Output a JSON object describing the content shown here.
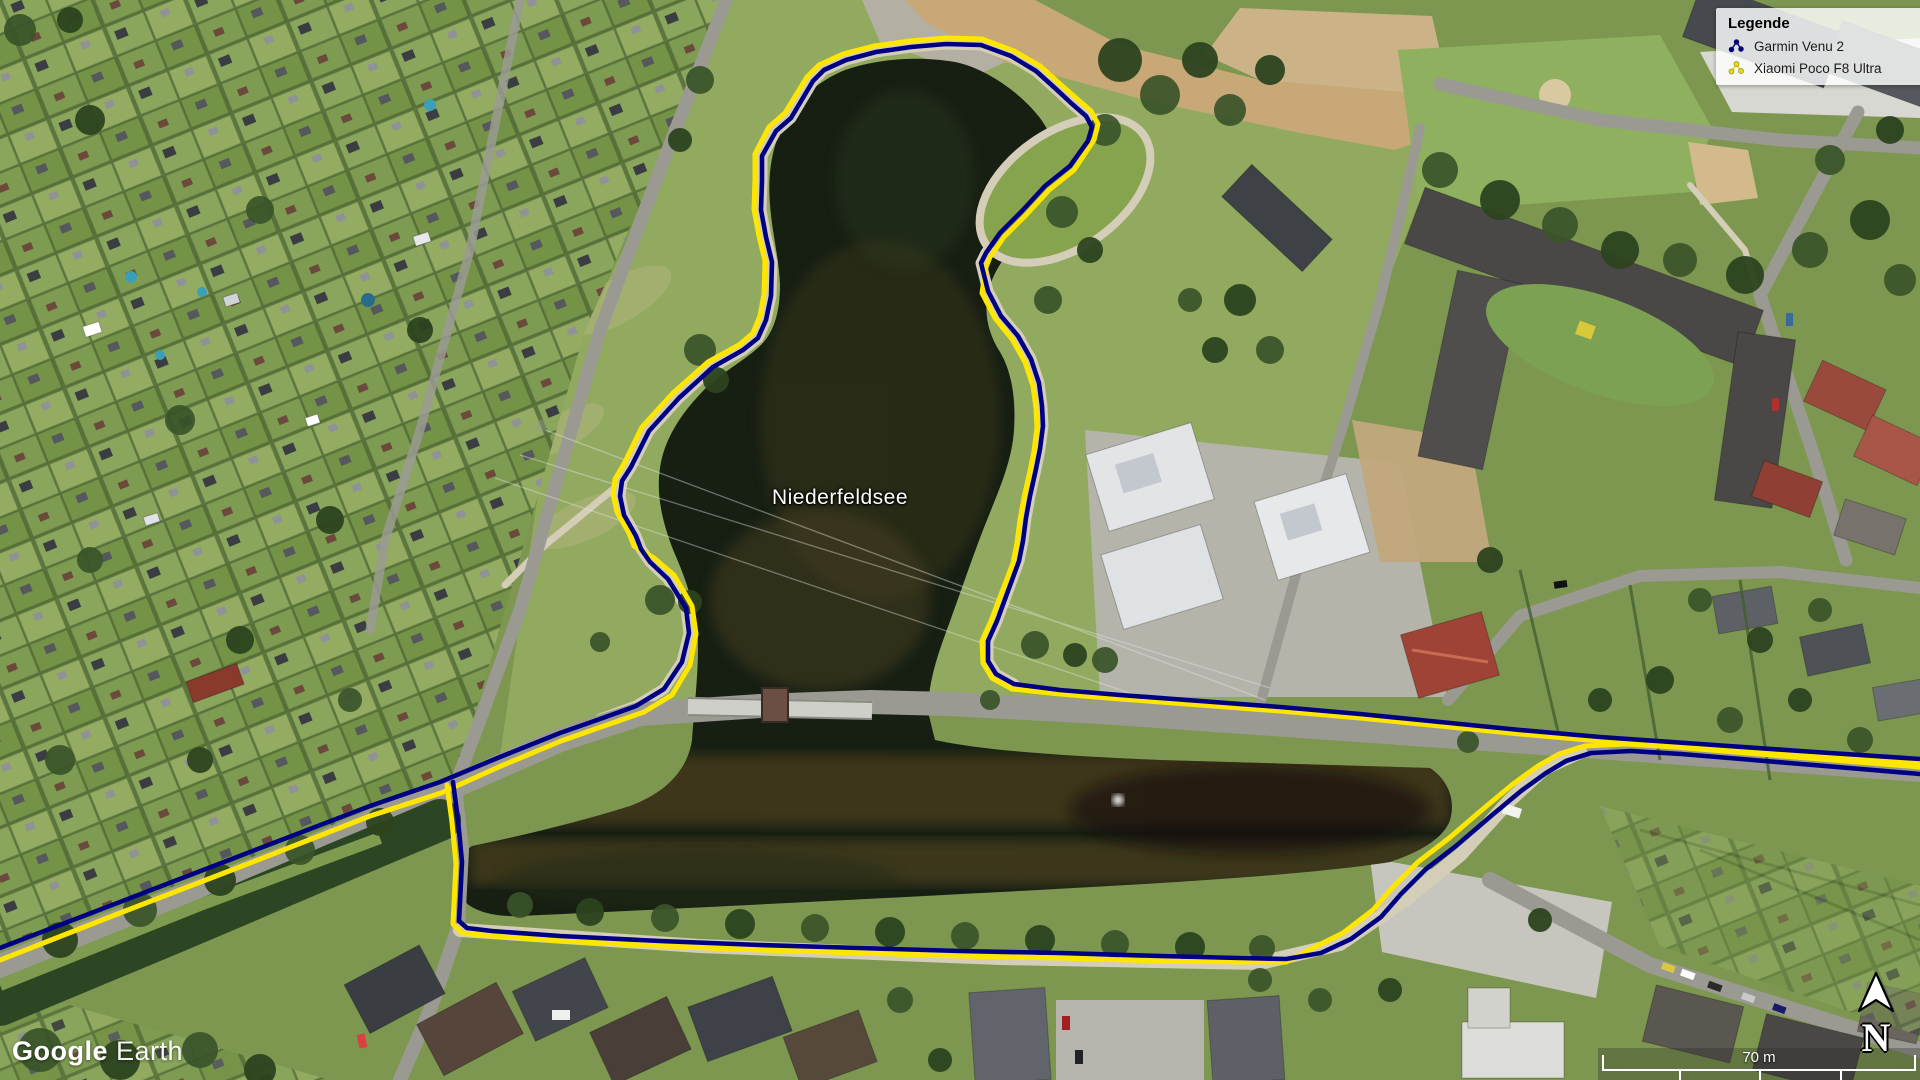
{
  "map": {
    "place_label": "Niederfeldsee",
    "watermark": {
      "brand": "Google",
      "product": "Earth"
    },
    "scale_bar": {
      "label": "70 m"
    },
    "north_indicator": {
      "letter": "N"
    },
    "legend": {
      "title": "Legende",
      "items": [
        {
          "label": "Garmin Venu 2",
          "icon": "track-dots-icon",
          "color": "#000082"
        },
        {
          "label": "Xiaomi Poco F8 Ultra",
          "icon": "track-dots-icon",
          "color": "#e9db00"
        }
      ]
    },
    "tracks": [
      {
        "id": "garmin-venu-2",
        "name": "Garmin Venu 2",
        "color": "#000082",
        "width": 4.6,
        "segments": [
          [
            [
              0,
              948
            ],
            [
              120,
              902
            ],
            [
              250,
              852
            ],
            [
              370,
              806
            ],
            [
              440,
              782
            ],
            [
              500,
              757
            ],
            [
              560,
              733
            ],
            [
              600,
              719
            ],
            [
              636,
              706
            ],
            [
              664,
              689
            ],
            [
              682,
              662
            ],
            [
              689,
              633
            ],
            [
              686,
              608
            ],
            [
              668,
              579
            ],
            [
              650,
              562
            ],
            [
              641,
              549
            ],
            [
              636,
              536
            ],
            [
              624,
              515
            ],
            [
              620,
              496
            ],
            [
              622,
              481
            ],
            [
              631,
              467
            ],
            [
              649,
              431
            ],
            [
              679,
              398
            ],
            [
              713,
              367
            ],
            [
              743,
              350
            ],
            [
              758,
              338
            ],
            [
              766,
              320
            ],
            [
              771,
              296
            ],
            [
              772,
              262
            ],
            [
              766,
              237
            ],
            [
              761,
              210
            ],
            [
              762,
              181
            ],
            [
              762,
              156
            ],
            [
              776,
              131
            ],
            [
              791,
              118
            ],
            [
              813,
              81
            ],
            [
              824,
              70
            ],
            [
              846,
              60
            ],
            [
              876,
              52
            ],
            [
              911,
              47
            ],
            [
              946,
              44
            ],
            [
              981,
              45
            ],
            [
              1011,
              56
            ],
            [
              1036,
              71
            ],
            [
              1056,
              89
            ],
            [
              1071,
              103
            ],
            [
              1086,
              116
            ],
            [
              1092,
              127
            ],
            [
              1088,
              141
            ],
            [
              1070,
              166
            ],
            [
              1045,
              186
            ],
            [
              1022,
              211
            ],
            [
              1000,
              233
            ],
            [
              986,
              253
            ],
            [
              981,
              263
            ],
            [
              988,
              291
            ],
            [
              1001,
              316
            ],
            [
              1018,
              336
            ],
            [
              1031,
              359
            ],
            [
              1039,
              383
            ],
            [
              1042,
              406
            ],
            [
              1043,
              426
            ],
            [
              1040,
              449
            ],
            [
              1036,
              469
            ],
            [
              1030,
              496
            ],
            [
              1026,
              518
            ],
            [
              1023,
              541
            ],
            [
              1019,
              561
            ],
            [
              1008,
              591
            ],
            [
              997,
              621
            ],
            [
              988,
              641
            ],
            [
              988,
              661
            ],
            [
              996,
              674
            ],
            [
              1014,
              684
            ],
            [
              1060,
              690
            ],
            [
              1120,
              695
            ],
            [
              1200,
              701
            ],
            [
              1280,
              707
            ],
            [
              1360,
              714
            ],
            [
              1440,
              722
            ],
            [
              1520,
              730
            ],
            [
              1600,
              737
            ],
            [
              1700,
              744
            ],
            [
              1800,
              751
            ],
            [
              1920,
              759
            ]
          ],
          [
            [
              453,
              782
            ],
            [
              458,
              820
            ],
            [
              462,
              862
            ],
            [
              460,
              902
            ],
            [
              459,
              921
            ],
            [
              467,
              928
            ],
            [
              492,
              931
            ],
            [
              560,
              936
            ],
            [
              660,
              941
            ],
            [
              760,
              945
            ],
            [
              860,
              948
            ],
            [
              960,
              951
            ],
            [
              1060,
              953
            ],
            [
              1160,
              956
            ],
            [
              1240,
              958
            ],
            [
              1286,
              959
            ],
            [
              1321,
              953
            ],
            [
              1351,
              939
            ],
            [
              1381,
              917
            ],
            [
              1401,
              894
            ],
            [
              1426,
              869
            ],
            [
              1456,
              846
            ],
            [
              1491,
              816
            ],
            [
              1521,
              791
            ],
            [
              1546,
              773
            ],
            [
              1566,
              761
            ],
            [
              1591,
              753
            ],
            [
              1631,
              751
            ],
            [
              1681,
              754
            ],
            [
              1741,
              759
            ],
            [
              1801,
              764
            ],
            [
              1920,
              774
            ]
          ]
        ]
      },
      {
        "id": "xiaomi-poco-f8-ultra",
        "name": "Xiaomi Poco F8 Ultra",
        "color": "#ffe600",
        "width": 5,
        "segments": [
          [
            [
              0,
              960
            ],
            [
              120,
              913
            ],
            [
              250,
              863
            ],
            [
              370,
              816
            ],
            [
              441,
              793
            ],
            [
              501,
              766
            ],
            [
              561,
              741
            ],
            [
              601,
              727
            ],
            [
              644,
              712
            ],
            [
              672,
              695
            ],
            [
              690,
              665
            ],
            [
              696,
              634
            ],
            [
              692,
              606
            ],
            [
              674,
              575
            ],
            [
              654,
              558
            ],
            [
              634,
              546
            ],
            [
              629,
              533
            ],
            [
              617,
              512
            ],
            [
              613,
              494
            ],
            [
              615,
              479
            ],
            [
              624,
              464
            ],
            [
              642,
              427
            ],
            [
              673,
              393
            ],
            [
              708,
              362
            ],
            [
              739,
              345
            ],
            [
              753,
              333
            ],
            [
              760,
              316
            ],
            [
              764,
              294
            ],
            [
              765,
              261
            ],
            [
              759,
              236
            ],
            [
              754,
              209
            ],
            [
              755,
              180
            ],
            [
              755,
              154
            ],
            [
              769,
              127
            ],
            [
              785,
              113
            ],
            [
              807,
              77
            ],
            [
              819,
              65
            ],
            [
              843,
              54
            ],
            [
              874,
              46
            ],
            [
              910,
              41
            ],
            [
              946,
              38
            ],
            [
              982,
              39
            ],
            [
              1014,
              51
            ],
            [
              1040,
              66
            ],
            [
              1060,
              84
            ],
            [
              1076,
              98
            ],
            [
              1091,
              111
            ],
            [
              1098,
              124
            ],
            [
              1094,
              140
            ],
            [
              1074,
              170
            ],
            [
              1049,
              190
            ],
            [
              1026,
              215
            ],
            [
              1004,
              237
            ],
            [
              990,
              257
            ],
            [
              986,
              267
            ],
            [
              982,
              293
            ],
            [
              995,
              318
            ],
            [
              1012,
              339
            ],
            [
              1025,
              362
            ],
            [
              1033,
              386
            ],
            [
              1036,
              408
            ],
            [
              1037,
              428
            ],
            [
              1034,
              451
            ],
            [
              1030,
              471
            ],
            [
              1024,
              498
            ],
            [
              1020,
              520
            ],
            [
              1017,
              543
            ],
            [
              1013,
              563
            ],
            [
              1002,
              592
            ],
            [
              991,
              621
            ],
            [
              982,
              641
            ],
            [
              983,
              663
            ],
            [
              992,
              678
            ],
            [
              1012,
              689
            ],
            [
              1060,
              694
            ],
            [
              1120,
              699
            ],
            [
              1200,
              705
            ],
            [
              1280,
              711
            ],
            [
              1360,
              718
            ],
            [
              1440,
              726
            ],
            [
              1520,
              734
            ],
            [
              1600,
              741
            ],
            [
              1700,
              748
            ],
            [
              1800,
              755
            ],
            [
              1920,
              763
            ]
          ],
          [
            [
              447,
              785
            ],
            [
              452,
              822
            ],
            [
              456,
              864
            ],
            [
              454,
              904
            ],
            [
              453,
              924
            ],
            [
              462,
              933
            ],
            [
              492,
              936
            ],
            [
              560,
              941
            ],
            [
              660,
              946
            ],
            [
              760,
              950
            ],
            [
              860,
              953
            ],
            [
              960,
              956
            ],
            [
              1060,
              958
            ],
            [
              1160,
              961
            ],
            [
              1240,
              962
            ],
            [
              1286,
              962
            ],
            [
              1313,
              948
            ],
            [
              1343,
              933
            ],
            [
              1373,
              910
            ],
            [
              1393,
              887
            ],
            [
              1418,
              862
            ],
            [
              1448,
              839
            ],
            [
              1483,
              809
            ],
            [
              1513,
              784
            ],
            [
              1538,
              766
            ],
            [
              1559,
              754
            ],
            [
              1585,
              746
            ],
            [
              1625,
              744
            ],
            [
              1675,
              747
            ],
            [
              1735,
              752
            ],
            [
              1795,
              757
            ],
            [
              1920,
              767
            ]
          ]
        ]
      }
    ]
  }
}
